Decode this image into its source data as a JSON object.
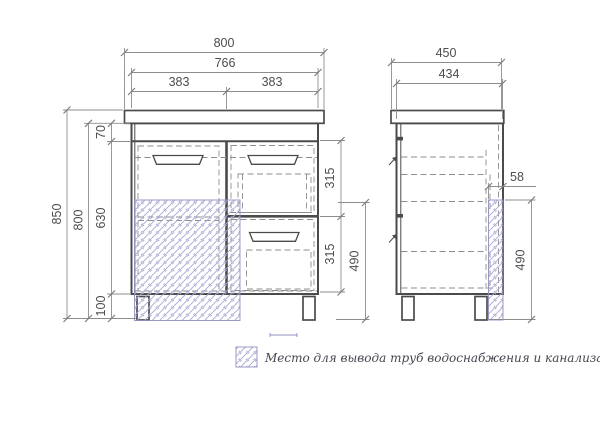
{
  "front": {
    "overall_width": "800",
    "body_width": "766",
    "left_section_width": "383",
    "right_section_width": "383",
    "overall_height": "850",
    "body_height": "800",
    "top_rail_height": "70",
    "middle_height": "630",
    "leg_height": "100",
    "drawer_top_height": "315",
    "drawer_bottom_height": "315",
    "pipe_zone_height": "490"
  },
  "side": {
    "overall_depth": "450",
    "body_depth": "434",
    "pipe_zone_depth": "58",
    "pipe_zone_height": "490"
  },
  "legend": {
    "label": "Место для вывода труб водоснабжения и канализации"
  },
  "colors": {
    "line": "#4b4b4b",
    "dim": "#8d8d8d",
    "dash": "#8d8d8d",
    "text": "#4d4d4d",
    "hatch_line": "#a9a9d4",
    "hatch_border": "#8f8fc0"
  }
}
